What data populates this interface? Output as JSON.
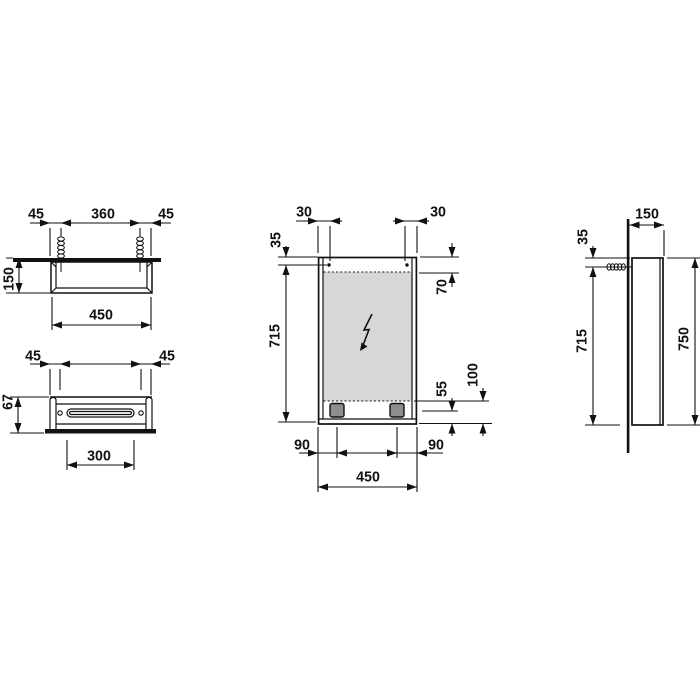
{
  "page": {
    "background": "#ffffff",
    "line_color": "#111111",
    "mirror_fill": "#d7d7d7",
    "socket_fill": "#8e8e8e"
  },
  "views": {
    "top_view": {
      "dims": {
        "mount_left": "45",
        "mount_spacing": "360",
        "mount_right": "45",
        "depth": "150",
        "width": "450"
      }
    },
    "bottom_view": {
      "dims": {
        "mount_left": "45",
        "mount_right": "45",
        "front_depth": "67",
        "slot_width": "300"
      }
    },
    "front_view": {
      "symbols": {
        "power": "lightning-bolt"
      },
      "dims": {
        "mount_inset_left": "30",
        "mount_inset_right": "30",
        "mount_top": "35",
        "glass_top": "70",
        "mount_height": "715",
        "socket_height": "55",
        "glass_bottom": "100",
        "socket_left": "90",
        "socket_right": "90",
        "width": "450"
      }
    },
    "side_view": {
      "dims": {
        "depth": "150",
        "mount_top": "35",
        "mount_height": "715",
        "height": "750"
      }
    }
  }
}
